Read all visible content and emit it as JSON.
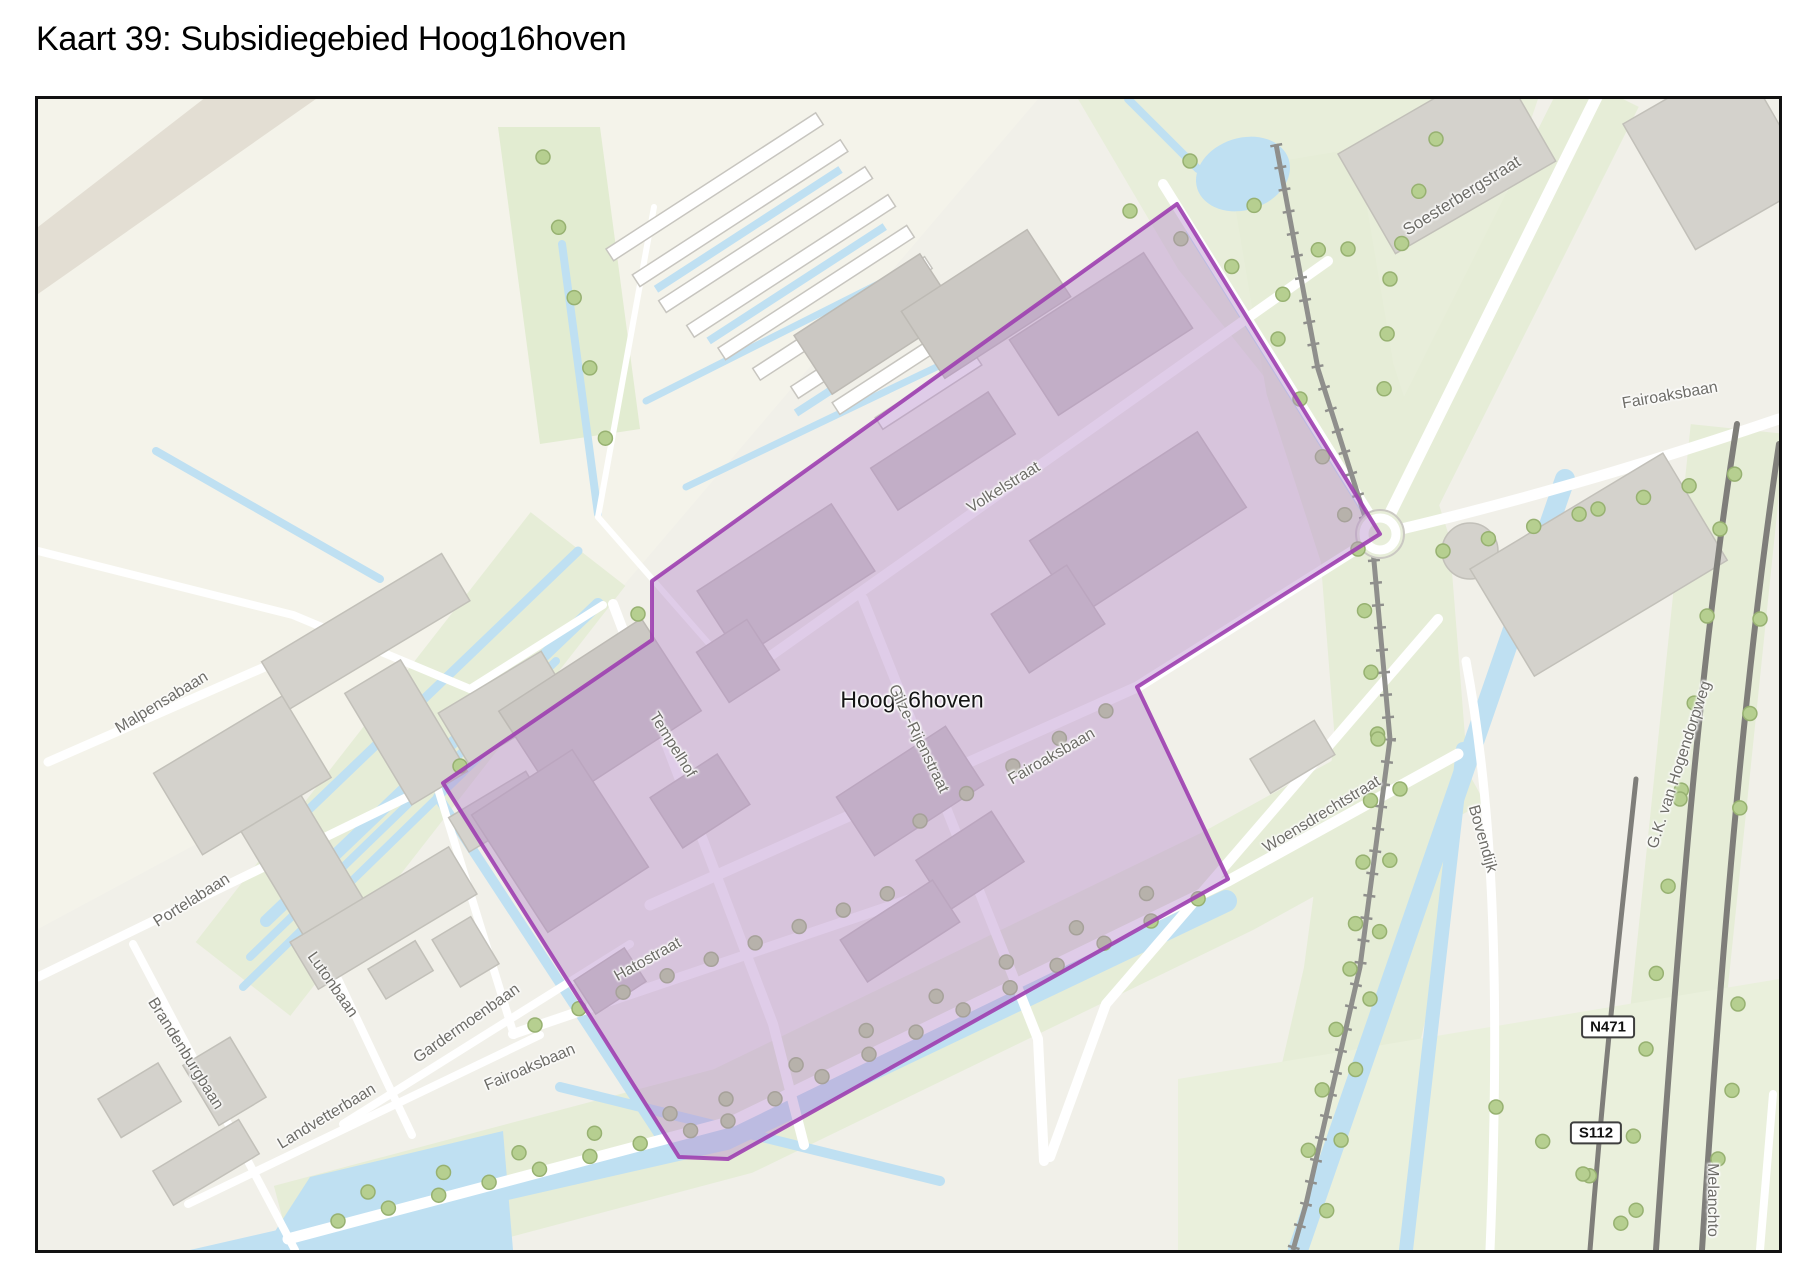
{
  "title": "Kaart 39: Subsidiegebied Hoog16hoven",
  "map": {
    "labels": [
      {
        "name": "area-label",
        "text": "Hoog16hoven",
        "x": 874,
        "y": 601,
        "rot": 0,
        "size": 23,
        "color": "#141414"
      },
      {
        "name": "street-label",
        "text": "Soesterbergstraat",
        "x": 1424,
        "y": 97,
        "rot": -32,
        "size": 17
      },
      {
        "name": "street-label",
        "text": "Fairoaksbaan",
        "x": 1632,
        "y": 297,
        "rot": -10,
        "size": 16
      },
      {
        "name": "street-label",
        "text": "Volkelstraat",
        "x": 966,
        "y": 389,
        "rot": -32,
        "size": 16
      },
      {
        "name": "street-label",
        "text": "Gilze-Rijenstraat",
        "x": 880,
        "y": 640,
        "rot": 64,
        "size": 16
      },
      {
        "name": "street-label",
        "text": "Tempelhof",
        "x": 634,
        "y": 646,
        "rot": 58,
        "size": 16
      },
      {
        "name": "street-label",
        "text": "Fairoaksbaan",
        "x": 1014,
        "y": 658,
        "rot": -30,
        "size": 16
      },
      {
        "name": "street-label",
        "text": "Woensdrechtstraat",
        "x": 1284,
        "y": 716,
        "rot": -31,
        "size": 16
      },
      {
        "name": "street-label",
        "text": "Bovendijk",
        "x": 1444,
        "y": 740,
        "rot": 74,
        "size": 16
      },
      {
        "name": "street-label",
        "text": "G.K. van Hogendorpweg",
        "x": 1642,
        "y": 666,
        "rot": -72,
        "size": 16
      },
      {
        "name": "street-label",
        "text": "Malpensabaan",
        "x": 124,
        "y": 604,
        "rot": -31,
        "size": 16
      },
      {
        "name": "street-label",
        "text": "Portelabaan",
        "x": 154,
        "y": 802,
        "rot": -32,
        "size": 16
      },
      {
        "name": "street-label",
        "text": "Lutonbaan",
        "x": 294,
        "y": 886,
        "rot": 55,
        "size": 16
      },
      {
        "name": "street-label",
        "text": "Brandenburgbaan",
        "x": 147,
        "y": 955,
        "rot": 58,
        "size": 16
      },
      {
        "name": "street-label",
        "text": "Landvetterbaan",
        "x": 289,
        "y": 1018,
        "rot": -31,
        "size": 16
      },
      {
        "name": "street-label",
        "text": "Gardermoenbaan",
        "x": 429,
        "y": 925,
        "rot": -35,
        "size": 16
      },
      {
        "name": "street-label",
        "text": "Fairoaksbaan",
        "x": 492,
        "y": 969,
        "rot": -23,
        "size": 16
      },
      {
        "name": "street-label",
        "text": "Hatostraat",
        "x": 610,
        "y": 861,
        "rot": -29,
        "size": 16
      },
      {
        "name": "street-label",
        "text": "Melanchto",
        "x": 1674,
        "y": 1101,
        "rot": 90,
        "size": 16
      }
    ],
    "road_shields": [
      {
        "text": "N471",
        "x": 1570,
        "y": 928
      },
      {
        "text": "S112",
        "x": 1558,
        "y": 1034
      }
    ],
    "colors": {
      "subsidy_fill": "#b98fcc",
      "subsidy_border": "#9d3fb0",
      "water": "#bfe0f2",
      "green": "#e6edd7",
      "building": "#d4d2cc",
      "road": "#ffffff",
      "railway": "#8f8f8c",
      "street_label": "#6e6d68"
    }
  }
}
